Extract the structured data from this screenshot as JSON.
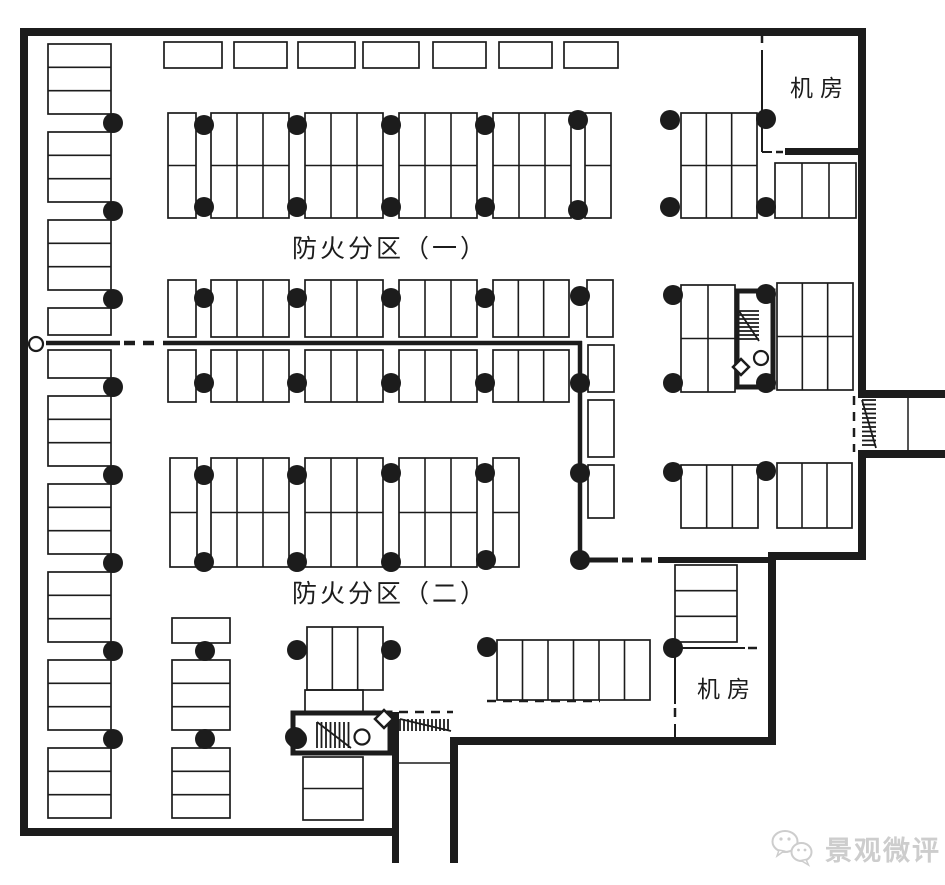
{
  "title": "地下车库平面图",
  "labels": {
    "zone1": "防火分区（一）",
    "zone2": "防火分区（二）",
    "machine_room_top": "机房",
    "machine_room_bottom": "机房",
    "watermark": "景观微评"
  },
  "colors": {
    "ink": "#1c1c1c",
    "background": "#ffffff",
    "watermark": "#cdcdcd"
  },
  "plan": {
    "walls": [
      [
        20,
        28,
        846,
        8
      ],
      [
        20,
        28,
        8,
        808
      ],
      [
        858,
        28,
        8,
        368
      ],
      [
        858,
        390,
        87,
        8
      ],
      [
        858,
        450,
        87,
        8
      ],
      [
        858,
        458,
        8,
        100
      ],
      [
        768,
        552,
        98,
        8
      ],
      [
        768,
        552,
        8,
        192
      ],
      [
        455,
        737,
        321,
        8
      ],
      [
        450,
        737,
        8,
        126
      ],
      [
        392,
        712,
        7,
        151
      ],
      [
        20,
        828,
        379,
        8
      ],
      [
        785,
        148,
        73,
        7
      ]
    ],
    "cores": [
      [
        293,
        713,
        97,
        40
      ],
      [
        737,
        291,
        36,
        96
      ]
    ],
    "fire_lines": [
      [
        46,
        343,
        120,
        343,
        4.5,
        0
      ],
      [
        124,
        343,
        160,
        343,
        4.5,
        1
      ],
      [
        163,
        343,
        582,
        343,
        4.5,
        0
      ],
      [
        580,
        341,
        580,
        562,
        4.5,
        0
      ],
      [
        580,
        560,
        618,
        560,
        5,
        0
      ],
      [
        622,
        560,
        656,
        560,
        5,
        1
      ],
      [
        658,
        560,
        770,
        560,
        6,
        0
      ]
    ],
    "thin_lines": [
      [
        762,
        50,
        762,
        143,
        2
      ],
      [
        762,
        143,
        762,
        152,
        2
      ],
      [
        762,
        152,
        772,
        152,
        2
      ],
      [
        677,
        648,
        745,
        648,
        2
      ],
      [
        675,
        650,
        675,
        704,
        2
      ],
      [
        675,
        724,
        675,
        738,
        2
      ],
      [
        908,
        398,
        908,
        450,
        1.5
      ],
      [
        399,
        763,
        450,
        763,
        1.5
      ]
    ],
    "dashes": [
      [
        399,
        712,
        453,
        712,
        2.5
      ],
      [
        487,
        701,
        600,
        701,
        2.5
      ],
      [
        854,
        396,
        854,
        452,
        2.5
      ],
      [
        762,
        34,
        762,
        47,
        2.5
      ],
      [
        776,
        152,
        783,
        152,
        2.5
      ],
      [
        748,
        648,
        758,
        648,
        2.5
      ],
      [
        675,
        708,
        675,
        722,
        2.5
      ]
    ],
    "stall_groups": [
      [
        164,
        42,
        58,
        26,
        1,
        1
      ],
      [
        234,
        42,
        53,
        26,
        1,
        1
      ],
      [
        298,
        42,
        57,
        26,
        1,
        1
      ],
      [
        363,
        42,
        56,
        26,
        1,
        1
      ],
      [
        433,
        42,
        53,
        26,
        1,
        1
      ],
      [
        499,
        42,
        53,
        26,
        1,
        1
      ],
      [
        564,
        42,
        54,
        26,
        1,
        1
      ],
      [
        48,
        44,
        63,
        70,
        1,
        3
      ],
      [
        48,
        132,
        63,
        70,
        1,
        3
      ],
      [
        48,
        220,
        63,
        70,
        1,
        3
      ],
      [
        48,
        308,
        63,
        27,
        1,
        1
      ],
      [
        48,
        350,
        63,
        28,
        1,
        1
      ],
      [
        48,
        396,
        63,
        70,
        1,
        3
      ],
      [
        48,
        484,
        63,
        70,
        1,
        3
      ],
      [
        48,
        572,
        63,
        70,
        1,
        3
      ],
      [
        48,
        660,
        63,
        70,
        1,
        3
      ],
      [
        48,
        748,
        63,
        70,
        1,
        3
      ],
      [
        172,
        618,
        58,
        25,
        1,
        1
      ],
      [
        172,
        660,
        58,
        70,
        1,
        3
      ],
      [
        172,
        748,
        58,
        70,
        1,
        3
      ],
      [
        168,
        113,
        28,
        105,
        1,
        2
      ],
      [
        211,
        113,
        78,
        105,
        3,
        2
      ],
      [
        305,
        113,
        78,
        105,
        3,
        2
      ],
      [
        399,
        113,
        78,
        105,
        3,
        2
      ],
      [
        493,
        113,
        78,
        105,
        3,
        2
      ],
      [
        585,
        113,
        26,
        105,
        1,
        2
      ],
      [
        681,
        113,
        76,
        105,
        3,
        2
      ],
      [
        775,
        163,
        81,
        55,
        3,
        1
      ],
      [
        168,
        280,
        28,
        57,
        1,
        1
      ],
      [
        211,
        280,
        78,
        57,
        3,
        1
      ],
      [
        305,
        280,
        78,
        57,
        3,
        1
      ],
      [
        399,
        280,
        78,
        57,
        3,
        1
      ],
      [
        493,
        280,
        76,
        57,
        3,
        1
      ],
      [
        587,
        280,
        26,
        57,
        1,
        1
      ],
      [
        168,
        350,
        28,
        52,
        1,
        1
      ],
      [
        211,
        350,
        78,
        52,
        3,
        1
      ],
      [
        305,
        350,
        78,
        52,
        3,
        1
      ],
      [
        399,
        350,
        78,
        52,
        3,
        1
      ],
      [
        493,
        350,
        76,
        52,
        3,
        1
      ],
      [
        588,
        345,
        26,
        47,
        1,
        1
      ],
      [
        588,
        400,
        26,
        57,
        1,
        1
      ],
      [
        588,
        465,
        26,
        53,
        1,
        1
      ],
      [
        681,
        285,
        54,
        107,
        2,
        2
      ],
      [
        777,
        283,
        76,
        107,
        3,
        2
      ],
      [
        170,
        458,
        27,
        109,
        1,
        2
      ],
      [
        211,
        458,
        78,
        109,
        3,
        2
      ],
      [
        305,
        458,
        78,
        109,
        3,
        2
      ],
      [
        399,
        458,
        78,
        109,
        3,
        2
      ],
      [
        493,
        458,
        26,
        109,
        1,
        2
      ],
      [
        681,
        465,
        77,
        63,
        3,
        1
      ],
      [
        777,
        463,
        75,
        65,
        3,
        1
      ],
      [
        307,
        627,
        76,
        63,
        3,
        1
      ],
      [
        305,
        690,
        58,
        22,
        1,
        1
      ],
      [
        497,
        640,
        153,
        60,
        6,
        1
      ],
      [
        675,
        565,
        62,
        77,
        1,
        3
      ],
      [
        303,
        757,
        60,
        63,
        1,
        2
      ]
    ],
    "dots": [
      [
        113,
        123
      ],
      [
        113,
        211
      ],
      [
        113,
        299
      ],
      [
        113,
        387
      ],
      [
        113,
        475
      ],
      [
        113,
        563
      ],
      [
        113,
        651
      ],
      [
        113,
        739
      ],
      [
        204,
        125
      ],
      [
        204,
        207
      ],
      [
        204,
        298
      ],
      [
        204,
        383
      ],
      [
        204,
        475
      ],
      [
        204,
        562
      ],
      [
        205,
        651
      ],
      [
        205,
        739
      ],
      [
        297,
        125
      ],
      [
        297,
        207
      ],
      [
        297,
        298
      ],
      [
        297,
        383
      ],
      [
        297,
        475
      ],
      [
        297,
        562
      ],
      [
        297,
        650
      ],
      [
        297,
        739
      ],
      [
        391,
        125
      ],
      [
        391,
        207
      ],
      [
        391,
        298
      ],
      [
        391,
        383
      ],
      [
        391,
        473
      ],
      [
        391,
        562
      ],
      [
        391,
        650
      ],
      [
        485,
        125
      ],
      [
        485,
        207
      ],
      [
        485,
        298
      ],
      [
        485,
        383
      ],
      [
        485,
        473
      ],
      [
        486,
        560
      ],
      [
        487,
        647
      ],
      [
        578,
        120
      ],
      [
        578,
        210
      ],
      [
        580,
        296
      ],
      [
        580,
        383
      ],
      [
        580,
        473
      ],
      [
        580,
        560
      ],
      [
        670,
        120
      ],
      [
        670,
        207
      ],
      [
        673,
        295
      ],
      [
        673,
        383
      ],
      [
        673,
        472
      ],
      [
        673,
        648
      ],
      [
        766,
        119
      ],
      [
        766,
        207
      ],
      [
        766,
        294
      ],
      [
        766,
        383
      ],
      [
        766,
        471
      ],
      [
        295,
        737
      ]
    ],
    "open_circles": [
      [
        36,
        344,
        7
      ],
      [
        362,
        737,
        7.5
      ],
      [
        761,
        358,
        7
      ]
    ],
    "diamonds": [
      [
        384,
        719,
        9
      ],
      [
        741,
        367,
        8
      ]
    ],
    "stair_hatches": [
      [
        317,
        722,
        34,
        26,
        "v",
        4.5
      ],
      [
        739,
        311,
        20,
        30,
        "h",
        4
      ],
      [
        400,
        719,
        51,
        12,
        "v",
        4
      ],
      [
        862,
        400,
        14,
        48,
        "h",
        4.5
      ]
    ]
  }
}
